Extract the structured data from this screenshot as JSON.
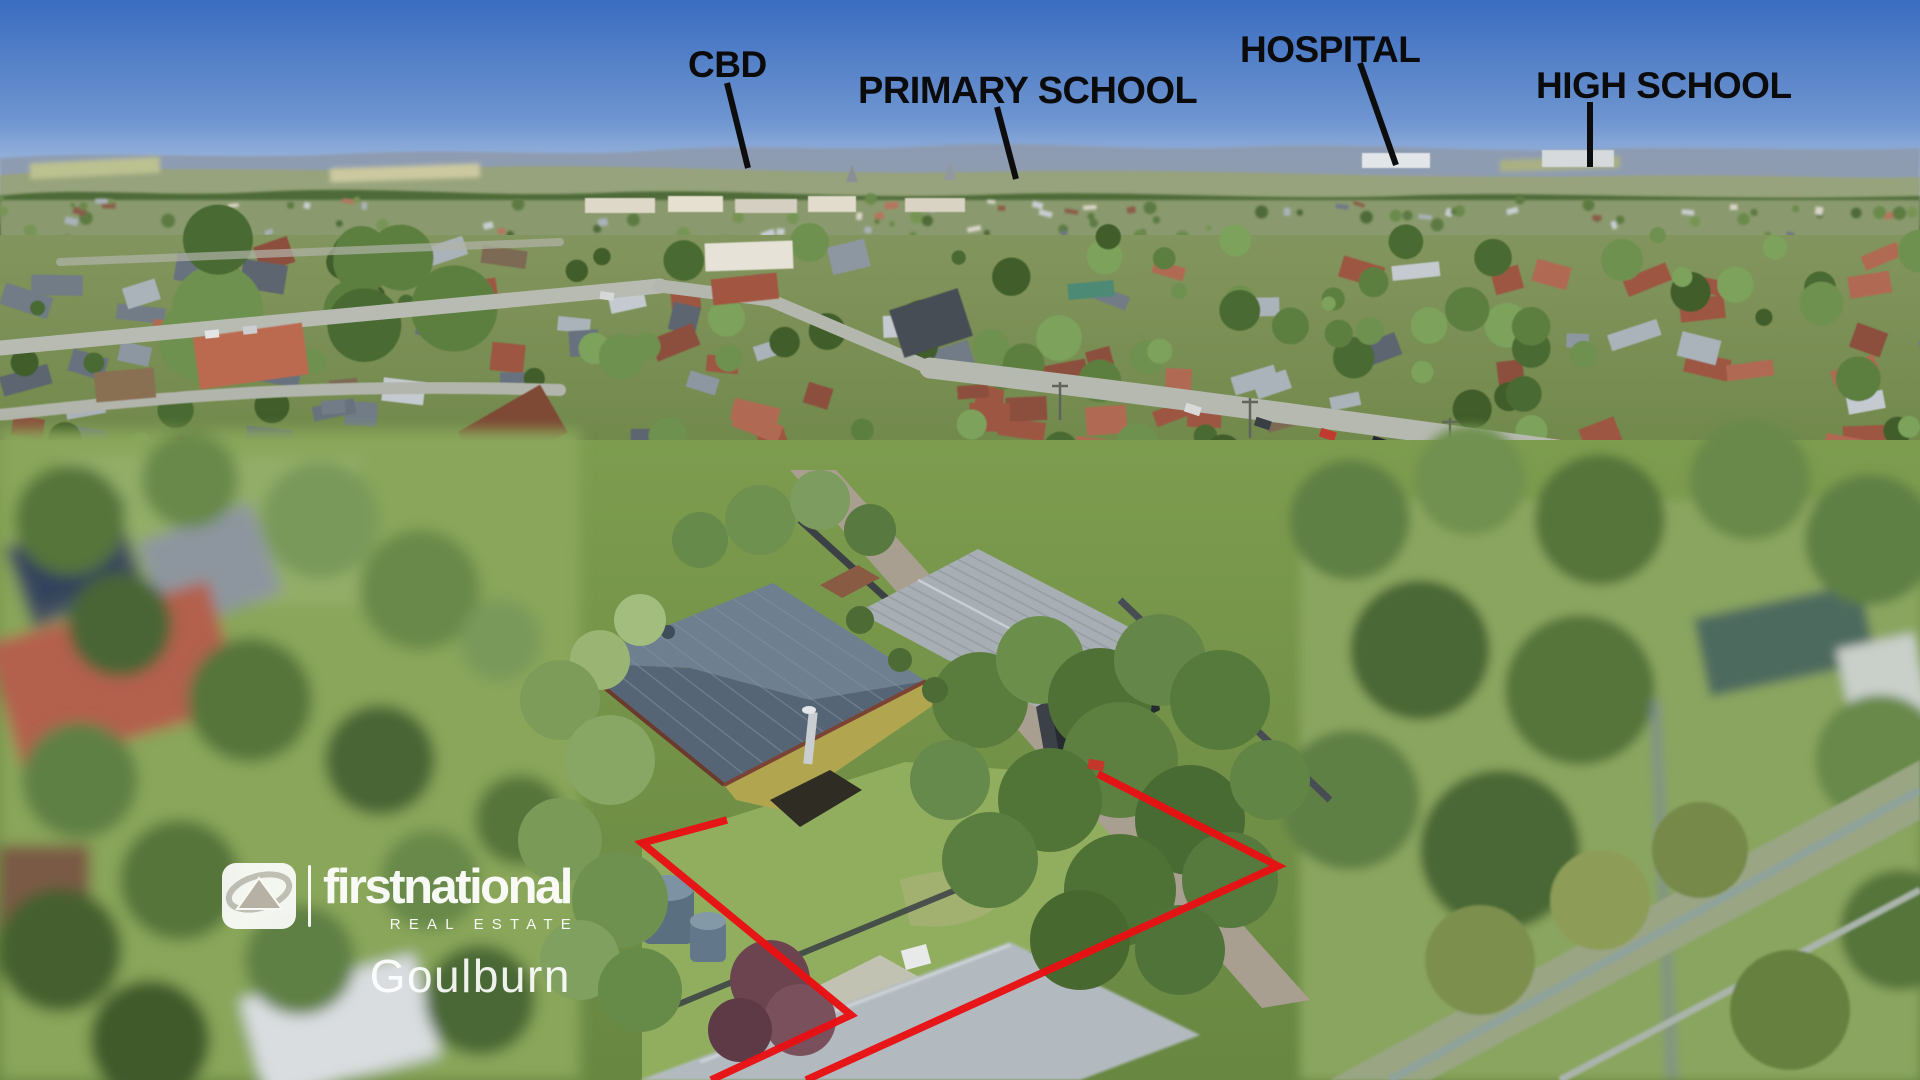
{
  "annotations": {
    "cbd": {
      "label": "CBD"
    },
    "primary_school": {
      "label": "PRIMARY SCHOOL"
    },
    "hospital": {
      "label": "HOSPITAL"
    },
    "high_school": {
      "label": "HIGH SCHOOL"
    }
  },
  "watermark": {
    "brand": "firstnational",
    "tagline": "REAL ESTATE",
    "office": "Goulburn"
  },
  "colors": {
    "boundary_red": "#e81114",
    "annotation_black": "#0b0b0b",
    "watermark_white": "#ffffff",
    "sky_top": "#3a6cc0",
    "sky_horizon": "#bccde6"
  }
}
